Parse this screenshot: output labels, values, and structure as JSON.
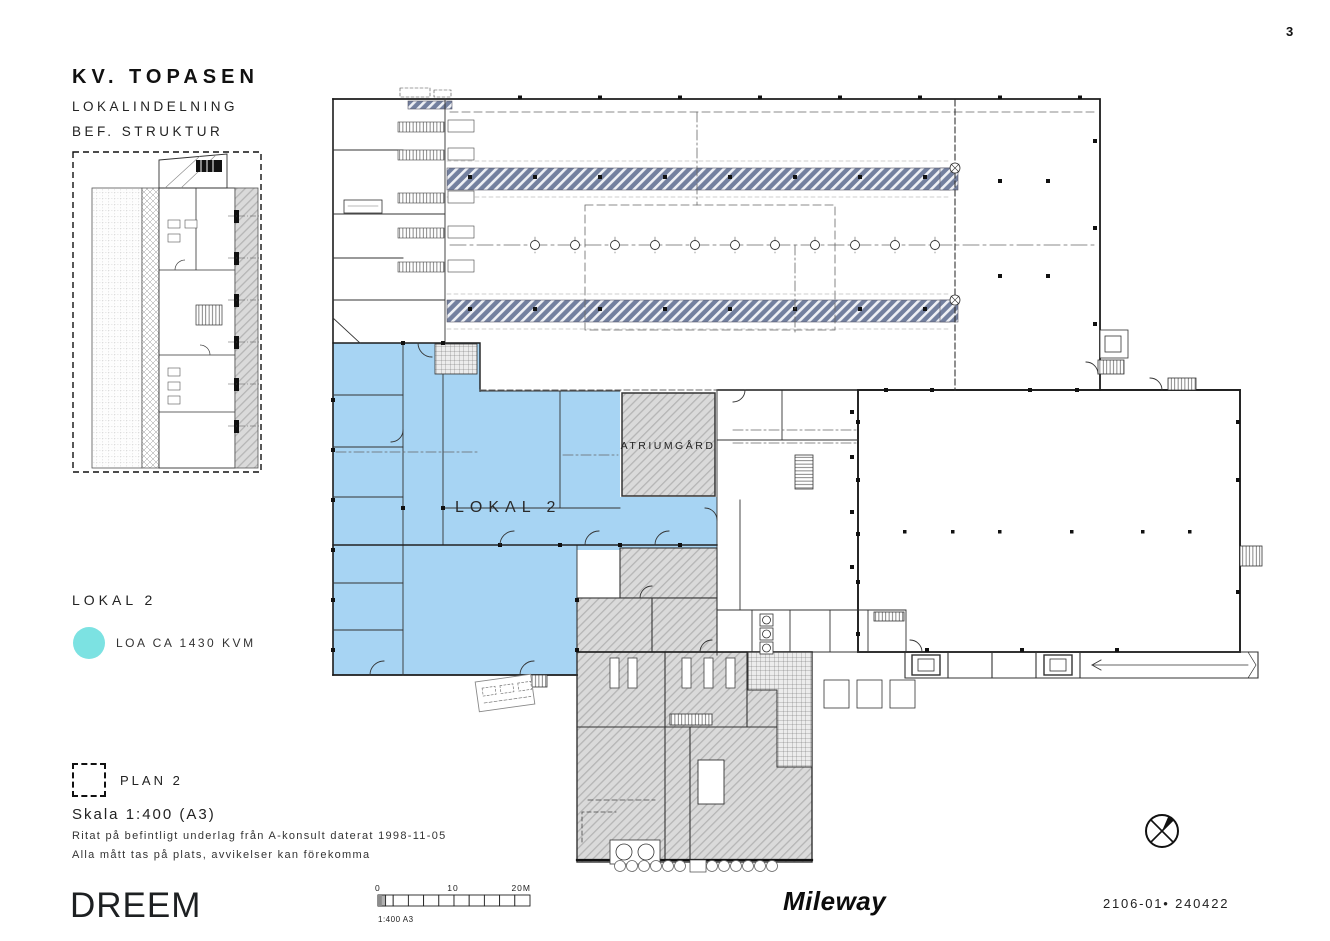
{
  "page": {
    "number": "3"
  },
  "title_block": {
    "project": "KV. TOPASEN",
    "line1": "LOKALINDELNING",
    "line2": "BEF. STRUKTUR"
  },
  "legend": {
    "heading": "LOKAL 2",
    "area_text": "LOA CA 1430 KVM"
  },
  "plan_ref": {
    "label": "PLAN 2"
  },
  "scale_info": {
    "scale": "Skala 1:400 (A3)",
    "note1": "Ritat på befintligt underlag från A-konsult daterat 1998-11-05",
    "note2": "Alla mått tas på plats, avvikelser kan förekomma"
  },
  "scale_bar": {
    "t0": "0",
    "t10": "10",
    "t20": "20M",
    "caption": "1:400 A3"
  },
  "floor_plan": {
    "lokal2": "LOKAL 2",
    "atrium": "ATRIUMGÅRD"
  },
  "footer": {
    "dreem": "DREEM",
    "mileway": "Mileway",
    "doc_number": "2106-01• 240422"
  },
  "colors": {
    "plan_fill": "#a7d4f3",
    "legend_dot": "#7ce2e2",
    "strip_fill": "#73809f",
    "hatch_fill": "#dadada"
  }
}
